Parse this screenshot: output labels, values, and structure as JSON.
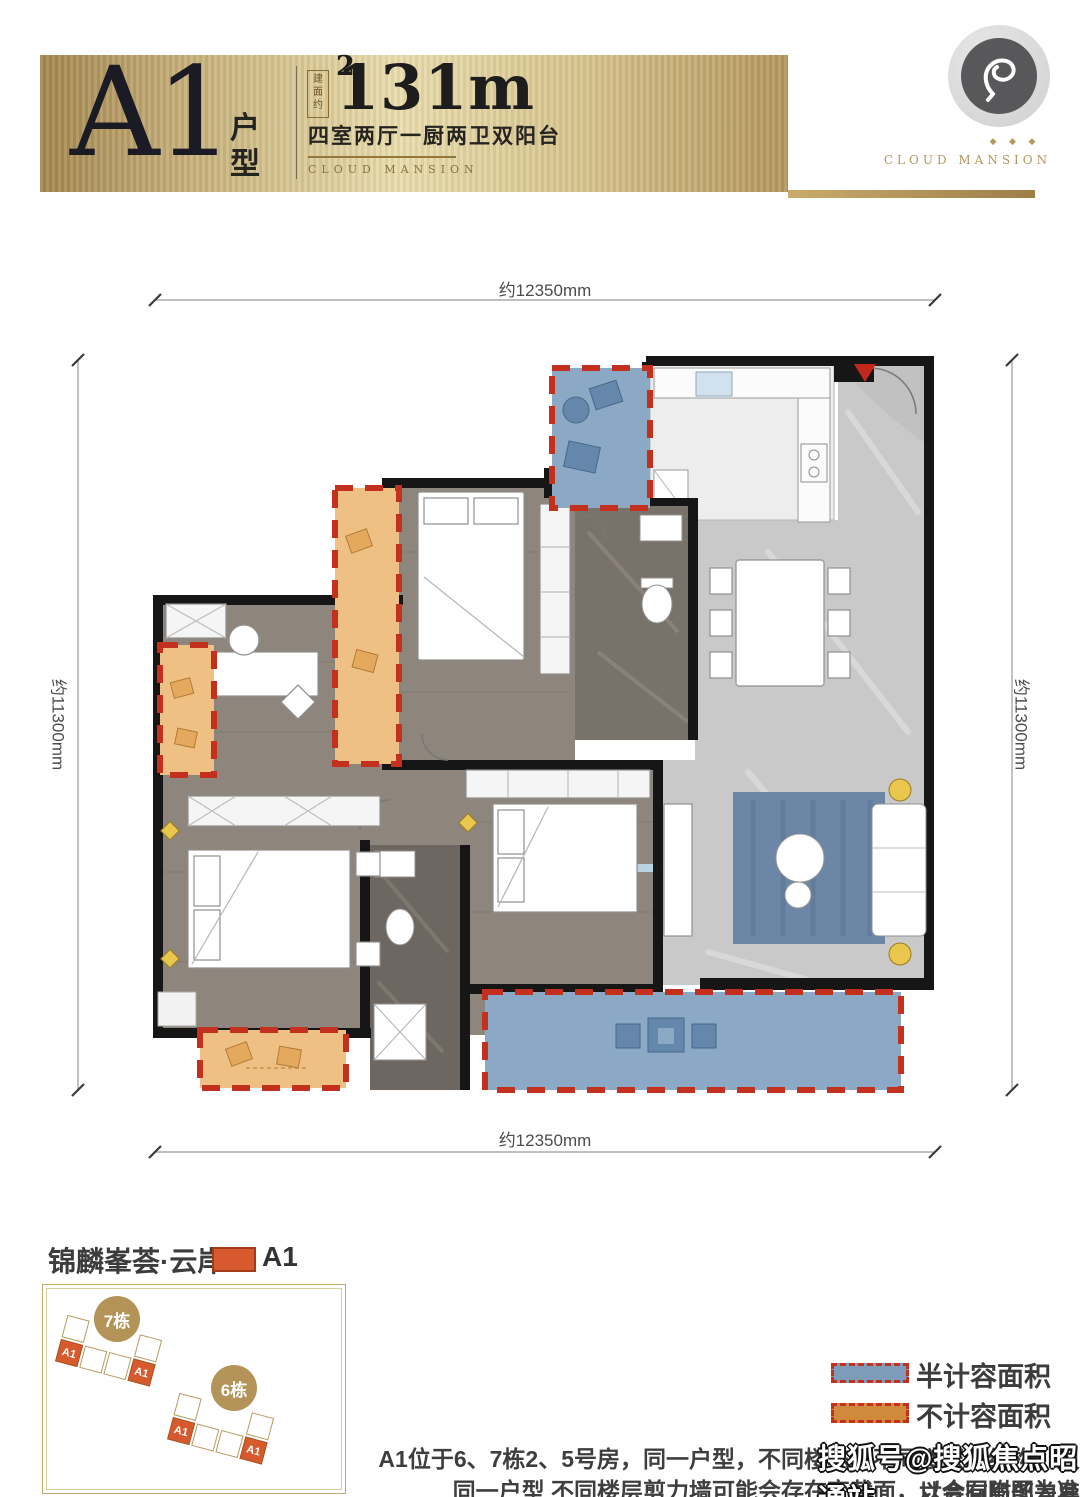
{
  "banner": {
    "plan_code": "A1",
    "plan_type_label": "户型",
    "area_prefix": "建面约",
    "area_value": "131m",
    "area_exponent": "2",
    "subtitle": "四室两厅一厨两卫双阳台",
    "brand": "CLOUD MANSION"
  },
  "logo": {
    "stars": "◆ ◆ ◆",
    "brand": "CLOUD MANSION"
  },
  "floorplan": {
    "dim_top": "约12350mm",
    "dim_bottom": "约12350mm",
    "dim_left": "约11300mm",
    "dim_right": "约11300mm"
  },
  "siteplan": {
    "title": "锦麟峯荟·云岸：",
    "swatch_label": "A1",
    "buildings": [
      {
        "name": "7栋",
        "unit_first": "A1",
        "unit_last": "A1"
      },
      {
        "name": "6栋",
        "unit_first": "A1",
        "unit_last": "A1"
      }
    ]
  },
  "legend": {
    "items": [
      {
        "label": "半计容面积",
        "color": "#7d9cba"
      },
      {
        "label": "不计容面积",
        "color": "#cf8a3c"
      }
    ]
  },
  "disclaimer": {
    "line1": "A1位于6、7栋2、5号房，同一户型，不同楼栋、不同楼层，结构、尺寸会有局部差异",
    "line2": "同一户型 不同楼层剪力墙可能会存在变截面，以合同附图为准"
  },
  "watermark": "搜狐号@搜狐焦点昭通站",
  "colors": {
    "gold": "#9a7c41",
    "dash_red": "#c4301e",
    "balcony_blue": "#8ba8c5",
    "balcony_orange": "#eec083",
    "unit_orange": "#d65a2d"
  }
}
